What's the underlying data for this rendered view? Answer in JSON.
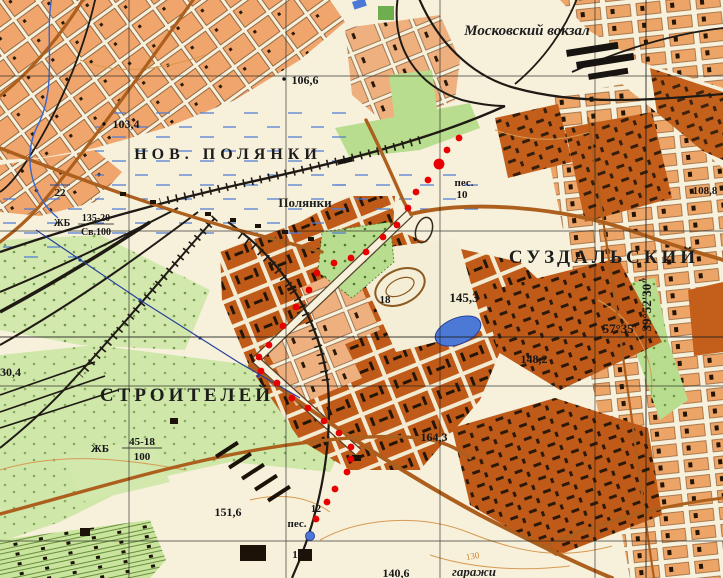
{
  "map": {
    "type": "soviet-topographic-map-fragment",
    "labels": {
      "station": "Московский вокзал",
      "district_top": "НОВ. ПОЛЯНКИ",
      "village": "Полянки",
      "district_right": "СУЗДАЛЬСКИЙ",
      "district_bottom": "СТРОИТЕЛЕЙ",
      "garages": "гаражи",
      "sand_top": {
        "name": "пес.",
        "number": "10"
      },
      "sand_bottom": {
        "name": "пес.",
        "number": "12"
      },
      "small_10": "10°",
      "river_width": "22",
      "road_number": "18",
      "contour_value": "130",
      "bridge_top": {
        "prefix": "ЖБ",
        "num": "135-20",
        "den": "Св.100"
      },
      "bridge_bottom": {
        "prefix": "ЖБ",
        "num": "45-18",
        "den": "100"
      },
      "heights": {
        "h106_6": "106,6",
        "h103_4": "103,4",
        "h108_8": "108,8",
        "h130_4": "130,4",
        "h145_3": "145,3",
        "h148_2": "148,2",
        "h164_3": "164,3",
        "h151_6": "151,6",
        "h140_6": "140,6"
      },
      "graticule": {
        "lat": "57°35'",
        "lon": "39°52'30″"
      }
    },
    "colors": {
      "background": "#f7f1dc",
      "block_light": "#efa56b",
      "block_dark": "#bf5a18",
      "green": "#b9dd8e",
      "green_pale": "#d2e8ad",
      "water": "#4d79d6",
      "water_label": "#2e55c0",
      "road": "#ad5f1e",
      "rail": "#1f1a14",
      "contour": "#d79a52",
      "track_red": "#e80000",
      "grid": "#1c1c1c"
    }
  },
  "track": {
    "color": "#e80000",
    "radius": 3.4,
    "big_radius": 5.4,
    "big_index": 2,
    "points": [
      [
        459,
        138
      ],
      [
        447,
        150
      ],
      [
        439,
        164
      ],
      [
        428,
        180
      ],
      [
        416,
        192
      ],
      [
        408,
        208
      ],
      [
        397,
        225
      ],
      [
        383,
        237
      ],
      [
        366,
        252
      ],
      [
        351,
        258
      ],
      [
        334,
        263
      ],
      [
        317,
        273
      ],
      [
        309,
        290
      ],
      [
        296,
        307
      ],
      [
        283,
        326
      ],
      [
        269,
        345
      ],
      [
        259,
        357
      ],
      [
        261,
        371
      ],
      [
        277,
        383
      ],
      [
        292,
        398
      ],
      [
        308,
        408
      ],
      [
        324,
        421
      ],
      [
        339,
        433
      ],
      [
        351,
        447
      ],
      [
        351,
        459
      ],
      [
        347,
        472
      ],
      [
        335,
        489
      ],
      [
        327,
        502
      ],
      [
        316,
        519
      ]
    ]
  }
}
